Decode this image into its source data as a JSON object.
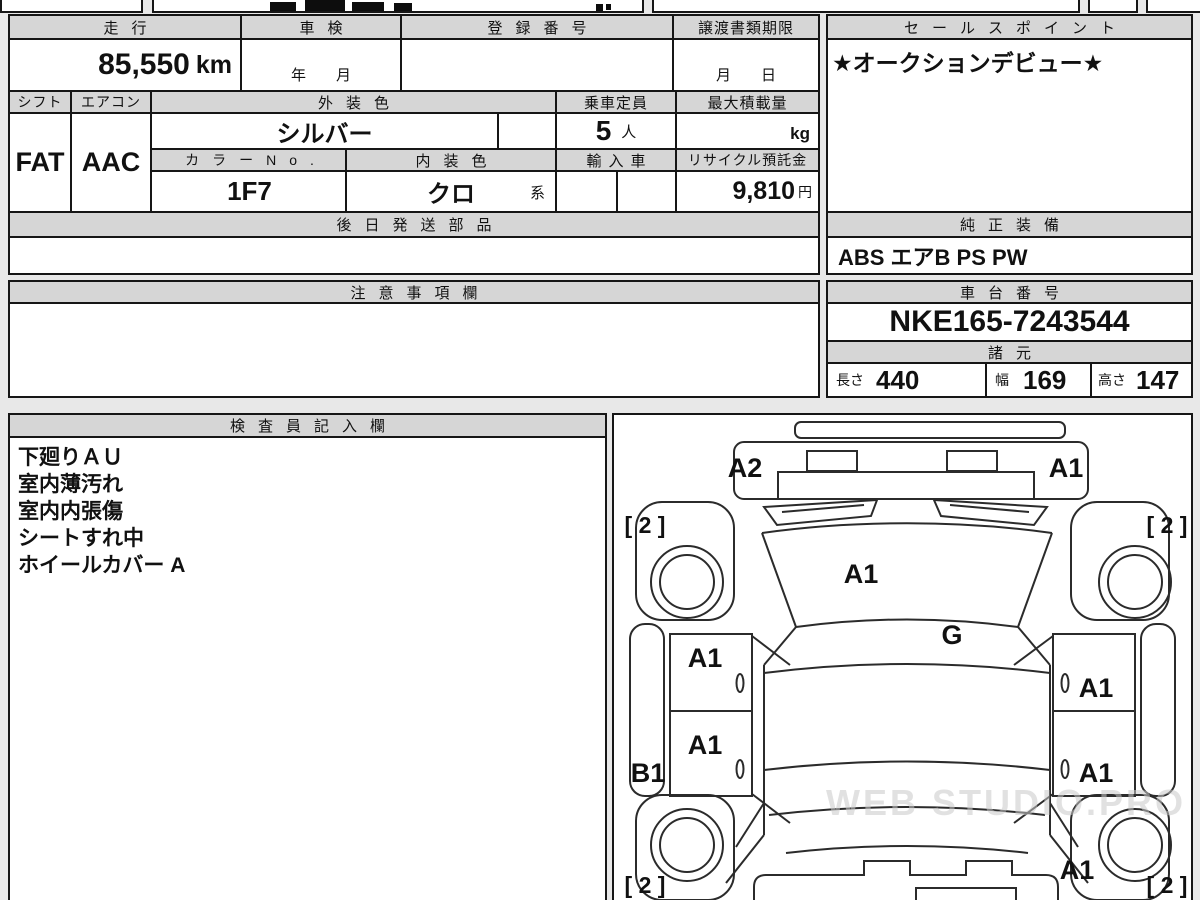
{
  "sheet": {
    "headers": {
      "mileage": "走行",
      "shaken": "車検",
      "registration_no": "登録番号",
      "transfer_doc_deadline": "譲渡書類期限",
      "sales_point": "セールスポイント",
      "shift": "シフト",
      "aircon": "エアコン",
      "exterior_color": "外装色",
      "seating_capacity": "乗車定員",
      "max_load": "最大積載量",
      "color_no": "カラーNo.",
      "interior_color": "内装色",
      "imported_car": "輸入車",
      "recycle_deposit": "リサイクル預託金",
      "parts_shipped_later": "後日発送部品",
      "genuine_equipment": "純正装備",
      "cautions": "注意事項欄",
      "chassis_no": "車台番号",
      "specs": "諸元",
      "length": "長さ",
      "width": "幅",
      "height": "高さ",
      "inspector_notes": "検査員記入欄"
    },
    "values": {
      "mileage": "85,550",
      "mileage_unit": "km",
      "shaken_date": "年　　月",
      "transfer_date": "月　　日",
      "sales_point": "★オークションデビュー★",
      "shift": "FAT",
      "aircon": "AAC",
      "exterior_color": "シルバー",
      "seating_capacity": "5",
      "seating_capacity_unit": "人",
      "max_load_unit": "kg",
      "color_no": "1F7",
      "interior_color": "クロ",
      "interior_color_suffix": "系",
      "recycle_deposit": "9,810",
      "recycle_deposit_unit": "円",
      "genuine_equipment": "ABS エアB PS PW",
      "chassis_no": "NKE165-7243544",
      "length": "440",
      "width": "169",
      "height": "147"
    },
    "inspector_notes": [
      "下廻りＡＵ",
      "室内薄汚れ",
      "室内内張傷",
      "シートすれ中",
      "ホイールカバー A"
    ],
    "diagram": {
      "front_bumper_left": "A2",
      "front_bumper_right": "A1",
      "hood": "A1",
      "windshield": "G",
      "front_left_door": "A1",
      "rear_left_door": "A1",
      "left_rocker": "B1",
      "front_right_door": "A1",
      "rear_right_door": "A1",
      "rear_right_quarter": "A1",
      "front_left_tire": "[ 2 ]",
      "front_right_tire": "[ 2 ]",
      "rear_left_tire": "[ 2 ]",
      "rear_right_tire": "[ 2 ]"
    },
    "watermark": "WEB STUDIO.PRO"
  }
}
